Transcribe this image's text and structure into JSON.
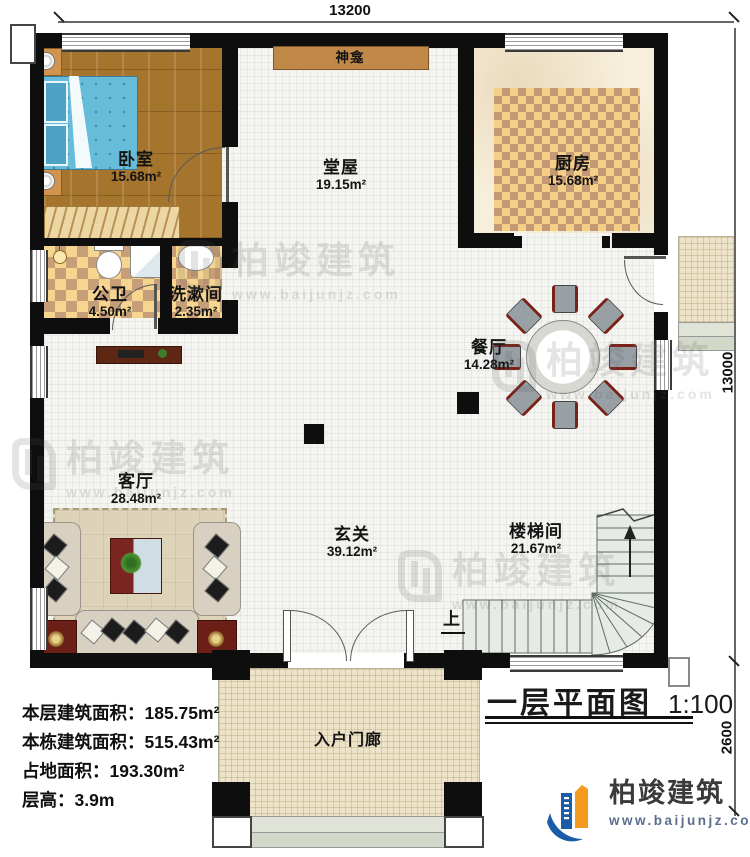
{
  "title_block": {
    "title": "一层平面图",
    "scale": "1:100"
  },
  "dimensions": {
    "top": "13200",
    "side": "13000",
    "porch_side": "2600"
  },
  "rooms": {
    "bedroom": {
      "name": "卧室",
      "area": "15.68m²"
    },
    "hall": {
      "name": "堂屋",
      "area": "19.15m²"
    },
    "kitchen": {
      "name": "厨房",
      "area": "15.68m²"
    },
    "bathroom": {
      "name": "公卫",
      "area": "4.50m²"
    },
    "washroom": {
      "name": "洗漱间",
      "area": "2.35m²"
    },
    "dining": {
      "name": "餐厅",
      "area": "14.28m²"
    },
    "living": {
      "name": "客厅",
      "area": "28.48m²"
    },
    "foyer": {
      "name": "玄关",
      "area": "39.12m²"
    },
    "stairwell": {
      "name": "楼梯间",
      "area": "21.67m²"
    }
  },
  "features": {
    "shrine": "神龛",
    "porch": "入户门廊",
    "stairs_up": "上"
  },
  "info_lines": [
    "本层建筑面积：185.75m²",
    "本栋建筑面积：515.43m²",
    "占地面积：193.30m²",
    "层高：3.9m"
  ],
  "watermark": {
    "name": "柏竣建筑",
    "site": "www.baijunjz.com"
  },
  "logo": {
    "name": "柏竣建筑",
    "site": "www.baijunjz.com"
  },
  "colors": {
    "wall": "#0e0e0e",
    "logo_blue": "#1a5ca8",
    "logo_orange": "#f49a1f",
    "logo_url_text": "#5c6d8e"
  }
}
